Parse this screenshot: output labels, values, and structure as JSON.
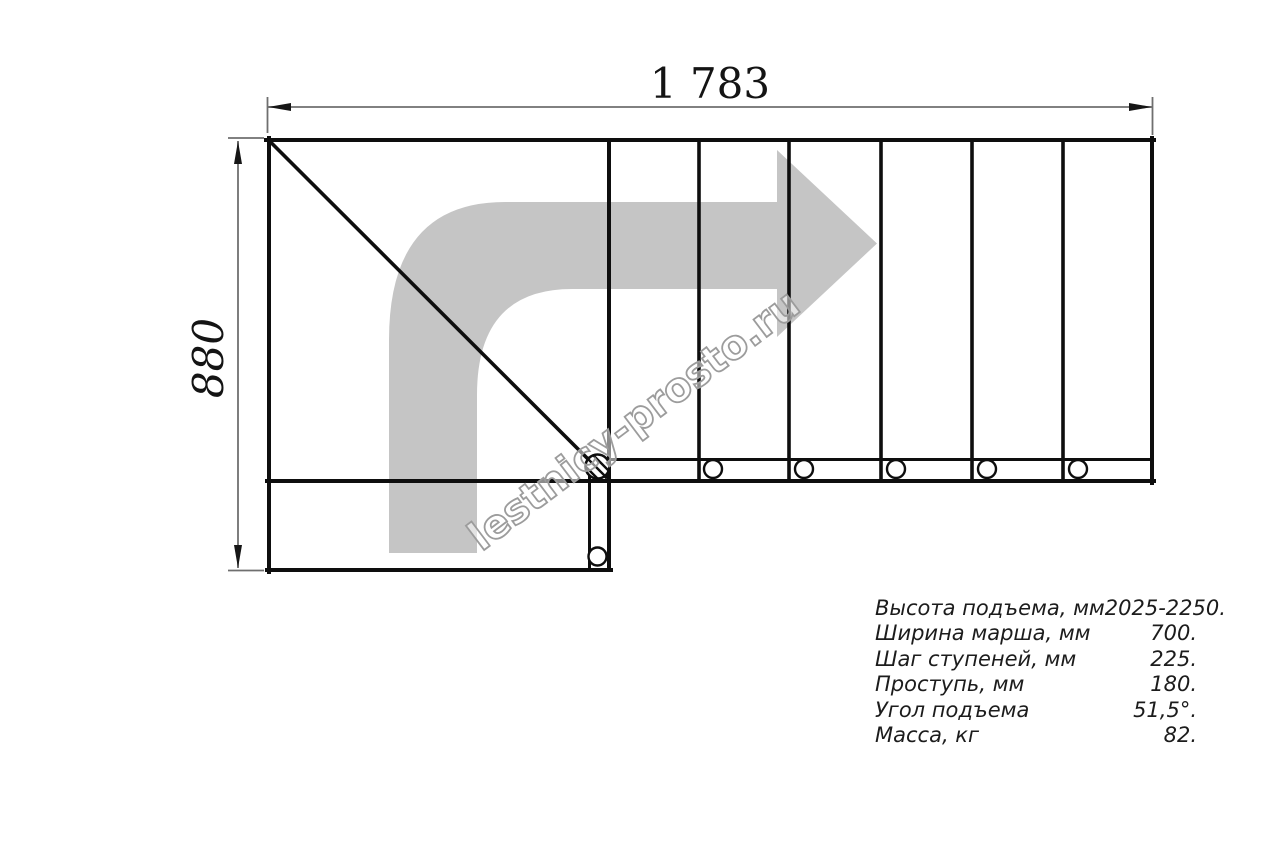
{
  "diagram": {
    "dim_width": "1 783",
    "dim_height": "880",
    "watermark": "lestnicy-prosto.ru",
    "specs": {
      "rows": [
        {
          "label": "Высота подъема, мм",
          "value": "2025-2250."
        },
        {
          "label": "Ширина марша, мм",
          "value": "700."
        },
        {
          "label": "Шаг ступеней, мм",
          "value": "225."
        },
        {
          "label": "Проступь, мм",
          "value": "180."
        },
        {
          "label": "Угол подъема",
          "value": "51,5°."
        },
        {
          "label": "Масса, кг",
          "value": "82."
        }
      ]
    },
    "colors": {
      "line": "#0e0e0e",
      "dimension_line": "#6f6f6f",
      "arrow_fill": "#c5c5c5",
      "watermark_stroke": "#9c9c9c",
      "text": "#1c1c1c"
    }
  }
}
